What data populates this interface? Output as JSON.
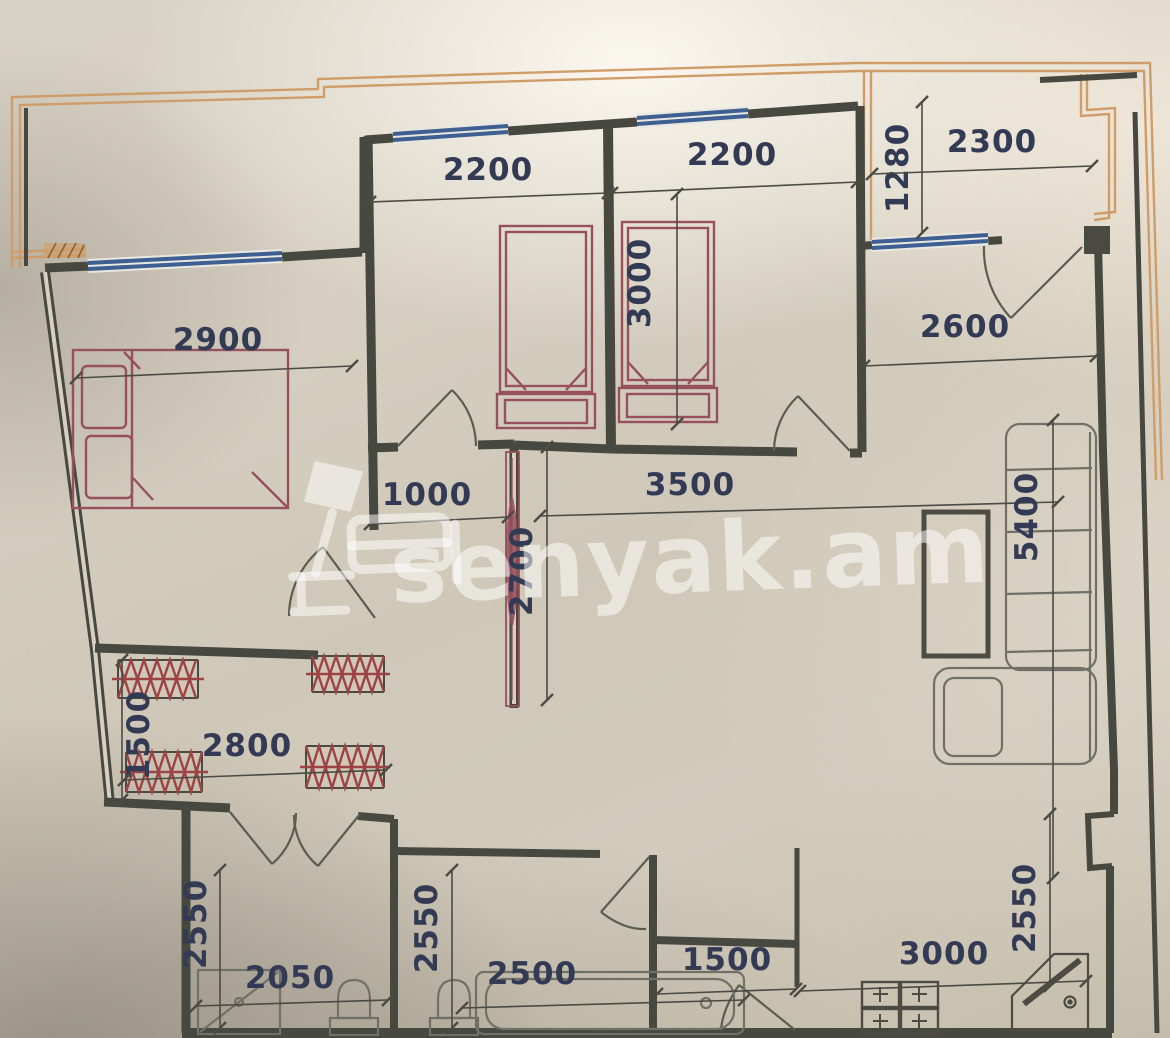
{
  "watermark": {
    "text": "senyak.am"
  },
  "colors": {
    "wall": "#474840",
    "thin_line": "#5b5c52",
    "dim_line": "#4a4b44",
    "dim_text": "#333a54",
    "furniture_red": "#96505e",
    "hatch_red": "#9e4343",
    "window_blue": "#3d5f92",
    "balcony_orange": "#cf9d69",
    "furniture_gray": "#6f7067",
    "watermark_white": "rgba(255,255,255,0.52)"
  },
  "dimensions": [
    {
      "value": "2200",
      "x": 488,
      "y": 180,
      "rot": 0,
      "line": [
        370,
        202,
        608,
        193
      ]
    },
    {
      "value": "2200",
      "x": 732,
      "y": 165,
      "rot": 0,
      "line": [
        612,
        193,
        857,
        182
      ]
    },
    {
      "value": "1280",
      "x": 908,
      "y": 168,
      "rot": -90,
      "line": [
        922,
        102,
        922,
        233
      ]
    },
    {
      "value": "2300",
      "x": 992,
      "y": 152,
      "rot": 0,
      "line": [
        872,
        174,
        1092,
        166
      ]
    },
    {
      "value": "3000",
      "x": 650,
      "y": 283,
      "rot": -90,
      "line": [
        677,
        194,
        677,
        424
      ]
    },
    {
      "value": "2900",
      "x": 218,
      "y": 350,
      "rot": 0,
      "line": [
        76,
        378,
        352,
        366
      ]
    },
    {
      "value": "2600",
      "x": 965,
      "y": 337,
      "rot": 0,
      "line": [
        864,
        366,
        1096,
        356
      ]
    },
    {
      "value": "1000",
      "x": 427,
      "y": 505,
      "rot": 0,
      "line": [
        370,
        524,
        508,
        517
      ]
    },
    {
      "value": "3500",
      "x": 690,
      "y": 495,
      "rot": 0,
      "line": [
        540,
        516,
        1058,
        502
      ]
    },
    {
      "value": "2700",
      "x": 532,
      "y": 571,
      "rot": -90,
      "line": [
        547,
        447,
        547,
        700
      ]
    },
    {
      "value": "5400",
      "x": 1037,
      "y": 517,
      "rot": -90,
      "line": [
        1053,
        420,
        1053,
        878
      ]
    },
    {
      "value": "1500",
      "x": 149,
      "y": 735,
      "rot": -90,
      "line": [
        122,
        660,
        122,
        800
      ]
    },
    {
      "value": "2800",
      "x": 247,
      "y": 756,
      "rot": 0,
      "line": [
        124,
        780,
        386,
        770
      ]
    },
    {
      "value": "2550",
      "x": 206,
      "y": 924,
      "rot": -90,
      "line": [
        220,
        870,
        220,
        1028
      ]
    },
    {
      "value": "2050",
      "x": 290,
      "y": 988,
      "rot": 0,
      "line": [
        196,
        1006,
        388,
        1000
      ]
    },
    {
      "value": "2550",
      "x": 437,
      "y": 928,
      "rot": -90,
      "line": [
        452,
        870,
        452,
        1028
      ]
    },
    {
      "value": "2500",
      "x": 532,
      "y": 984,
      "rot": 0,
      "line": [
        462,
        1008,
        744,
        1000
      ]
    },
    {
      "value": "1500",
      "x": 727,
      "y": 970,
      "rot": 0,
      "line": [
        657,
        994,
        796,
        989
      ]
    },
    {
      "value": "3000",
      "x": 944,
      "y": 964,
      "rot": 0,
      "line": [
        800,
        991,
        1086,
        981
      ]
    },
    {
      "value": "2550",
      "x": 1035,
      "y": 908,
      "rot": -90,
      "line": [
        1050,
        814,
        1050,
        986
      ]
    }
  ]
}
